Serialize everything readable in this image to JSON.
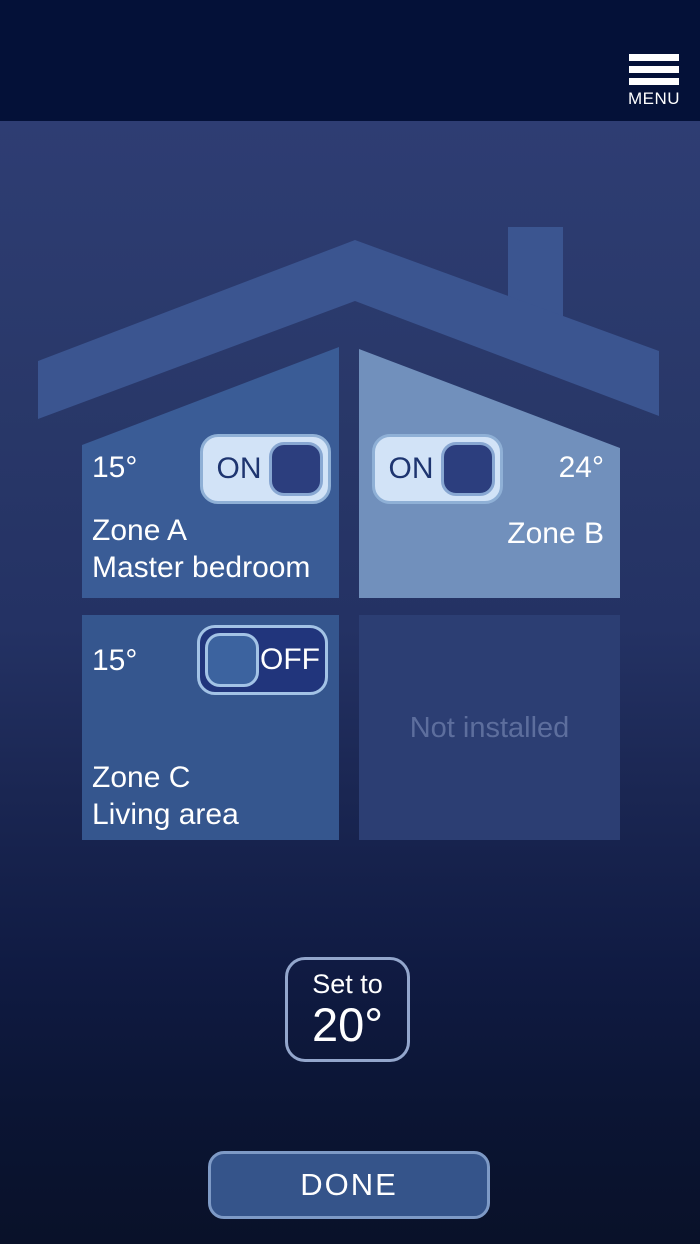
{
  "header": {
    "menu_label": "MENU"
  },
  "zones": [
    {
      "name": "Zone A",
      "room": "Master bedroom",
      "temperature": "15°",
      "power": "ON"
    },
    {
      "name": "Zone B",
      "temperature": "24°",
      "power": "ON"
    },
    {
      "name": "Zone C",
      "room": "Living area",
      "temperature": "15°",
      "power": "OFF"
    },
    {
      "status": "Not installed"
    }
  ],
  "setpoint": {
    "label": "Set to",
    "value": "20°"
  },
  "actions": {
    "done": "DONE"
  },
  "colors": {
    "header_bg": "#041138",
    "background_top": "#2e3d73",
    "background_bottom": "#091129",
    "roof": "#3b5590",
    "zone_a_panel": "#3a5c96",
    "zone_b_panel": "#7190bc",
    "zone_c_panel": "#35568e",
    "not_installed_panel": "#2c3e73",
    "not_installed_text": "#5d6e9d",
    "toggle_on_track": "#d2e3f7",
    "toggle_on_knob": "#2c3e7e",
    "toggle_on_text": "#1e3570",
    "toggle_off_track": "#21357c",
    "toggle_off_knob": "#3c639f",
    "button_fill": "#35548a",
    "button_border": "#7e9ac6",
    "text": "#ffffff"
  }
}
